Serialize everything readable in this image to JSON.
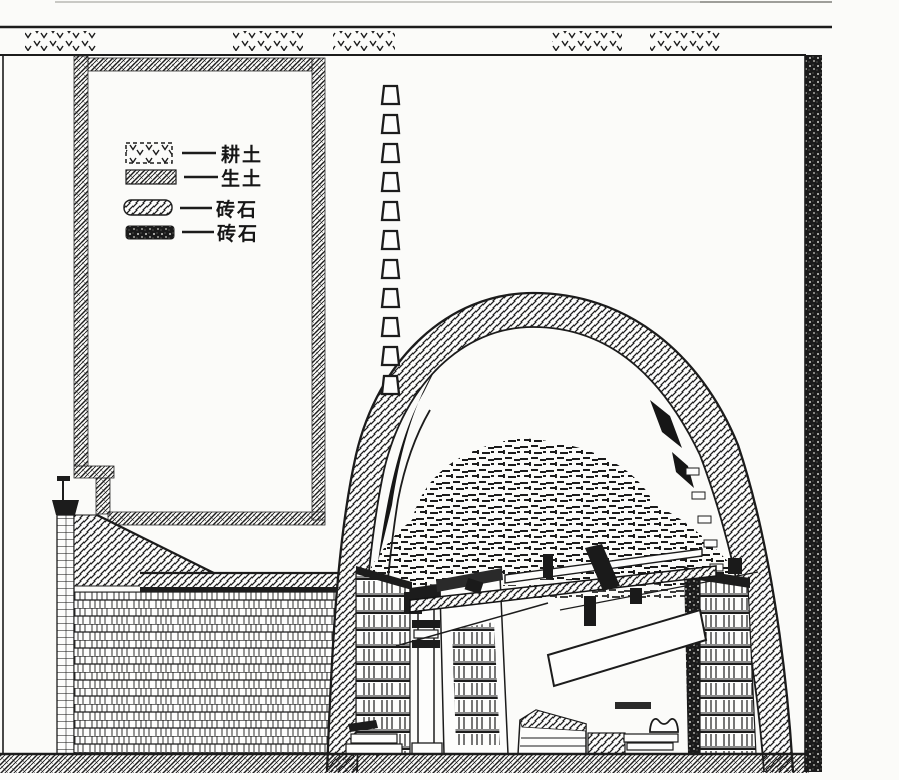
{
  "figure": {
    "paper_color": "#fbfbf9",
    "ink_color": "#1c1c1c"
  },
  "legend": {
    "items": [
      {
        "label": "耕土",
        "swatch": "topsoil-v-marks"
      },
      {
        "label": "生土",
        "swatch": "virgin-soil-crosshatch"
      },
      {
        "label": "砖石",
        "swatch": "brick-diagonal-hatch"
      },
      {
        "label": "砖石",
        "swatch": "dark-rubble-speckle"
      }
    ]
  }
}
